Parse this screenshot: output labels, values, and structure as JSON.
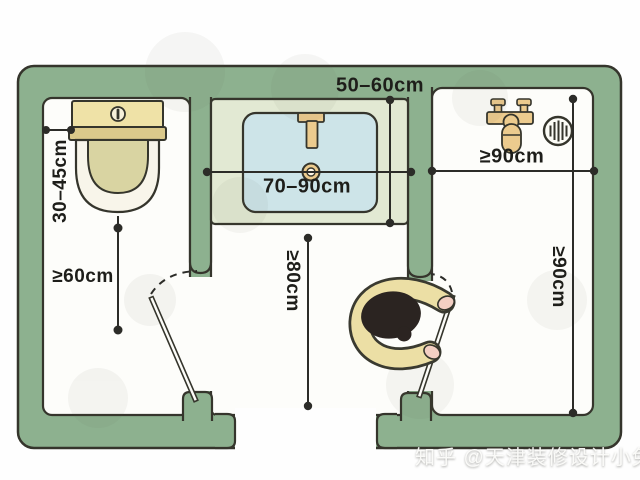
{
  "plan": {
    "labels": {
      "counter_depth": "50–60cm",
      "toilet_side_clearance": "30–45cm",
      "vanity_width": "70–90cm",
      "shower_entry_width": "≥90cm",
      "toilet_front_clearance": "≥60cm",
      "passage_width": "≥80cm",
      "shower_depth": "≥90cm"
    },
    "colors": {
      "wall_green": "#8DB18F",
      "counter_green": "#E2E9D3",
      "basin_blue": "#CDE4E8",
      "fixture_tan": "#ECCB8E",
      "toilet_tank_beige": "#EFE2A7",
      "outline_dark": "#35352C",
      "dimension_line": "#2C2C28"
    },
    "fixtures": [
      "toilet",
      "vanity-basin",
      "faucet",
      "shower-mixer",
      "hand-shower",
      "floor-drain",
      "swing-door-left",
      "swing-door-right",
      "person-top-view"
    ]
  },
  "watermark": {
    "text": "知乎 @天津装修设计小兔"
  }
}
